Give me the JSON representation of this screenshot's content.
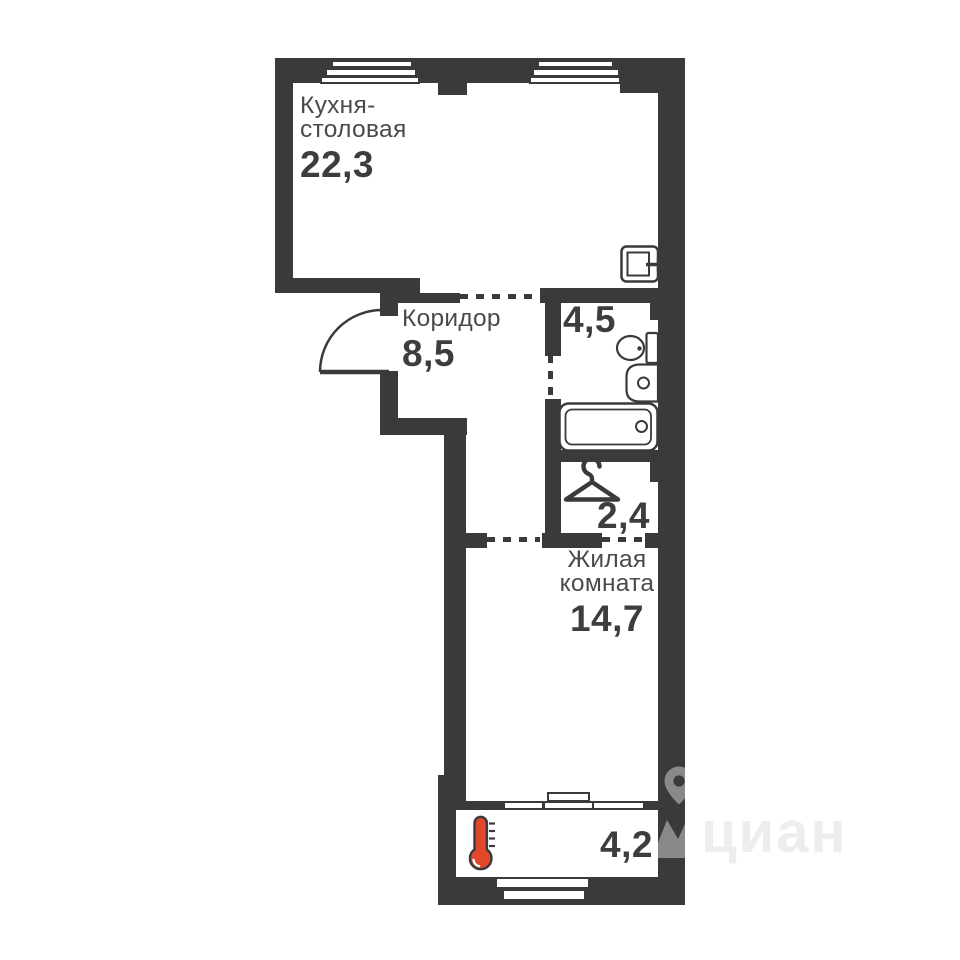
{
  "colors": {
    "wall": "#3a3a3c",
    "name-text": "#4a4a4c",
    "number-text": "#3d3d3f",
    "accent-red": "#e2462b",
    "watermark-text": "#ededed"
  },
  "rooms": [
    {
      "key": "kitchen",
      "name_line1": "Кухня-",
      "name_line2": "столовая",
      "area": "22,3"
    },
    {
      "key": "corridor",
      "name_line1": "Коридор",
      "area": "8,5"
    },
    {
      "key": "bathroom",
      "area": "4,5"
    },
    {
      "key": "wardrobe",
      "area": "2,4"
    },
    {
      "key": "living",
      "name_line1": "Жилая",
      "name_line2": "комната",
      "area": "14,7"
    },
    {
      "key": "balcony",
      "area": "4,2"
    }
  ],
  "icons": [
    "entry-door-arc",
    "hatch-icon",
    "toilet-icon",
    "sink-icon",
    "bathtub-icon",
    "hanger-icon",
    "thermometer-icon",
    "map-pin-icon"
  ],
  "watermark": {
    "brand": "циан"
  }
}
